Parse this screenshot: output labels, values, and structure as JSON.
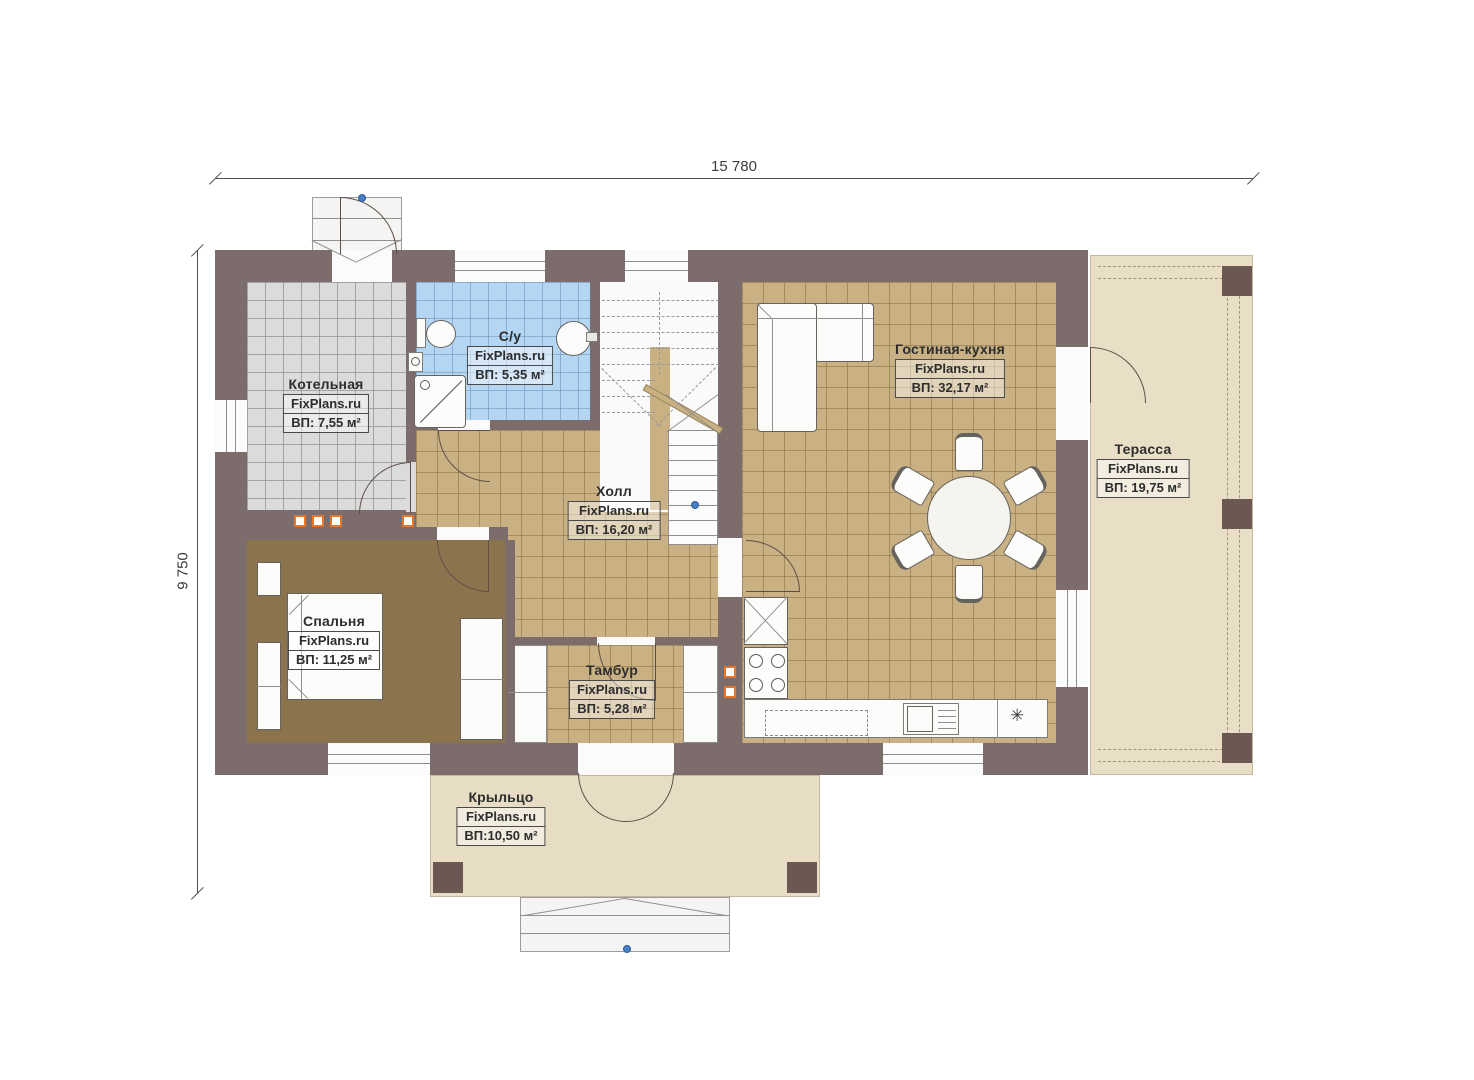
{
  "plan": {
    "dimensions": {
      "width": "15 780",
      "height": "9 750"
    },
    "kitchen_symbol": "✳",
    "rooms": [
      {
        "name": "Котельная",
        "brand": "FixPlans.ru",
        "area": "ВП: 7,55 м²"
      },
      {
        "name": "С/у",
        "brand": "FixPlans.ru",
        "area": "ВП: 5,35 м²"
      },
      {
        "name": "Гостиная-кухня",
        "brand": "FixPlans.ru",
        "area": "ВП: 32,17 м²"
      },
      {
        "name": "Терасса",
        "brand": "FixPlans.ru",
        "area": "ВП: 19,75 м²"
      },
      {
        "name": "Холл",
        "brand": "FixPlans.ru",
        "area": "ВП: 16,20 м²"
      },
      {
        "name": "Спальня",
        "brand": "FixPlans.ru",
        "area": "ВП: 11,25 м²"
      },
      {
        "name": "Тамбур",
        "brand": "FixPlans.ru",
        "area": "ВП: 5,28 м²"
      },
      {
        "name": "Крыльцо",
        "brand": "FixPlans.ru",
        "area": "ВП:10,50 м²"
      }
    ],
    "colors": {
      "wall": "#7d6c6c",
      "floor_tan": "#c9b183",
      "floor_gray": "#dbdbdb",
      "floor_blue": "#b4d6f2",
      "floor_bedroom": "#8b744d",
      "floor_terrace": "#e9dfc7",
      "post": "#6b5852",
      "flue_accent": "#e8762a",
      "marker_blue": "#4a7fc1"
    }
  }
}
